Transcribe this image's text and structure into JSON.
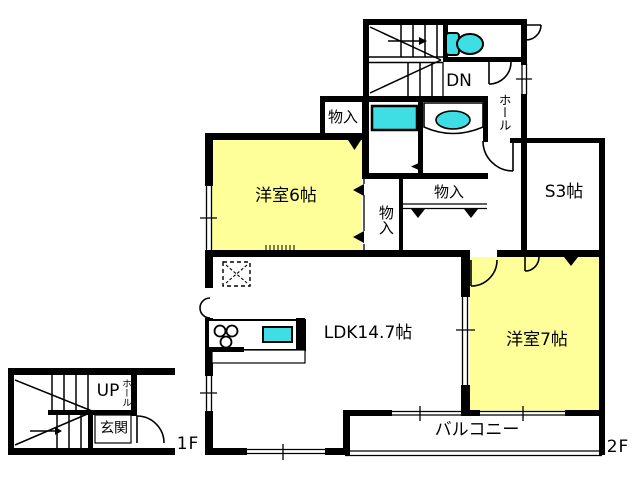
{
  "plan": {
    "floor_labels": {
      "first": "1F",
      "second": "2F"
    },
    "rooms": {
      "bedroom6": "洋室6帖",
      "bedroom7": "洋室7帖",
      "ldk": "LDK14.7帖",
      "storage_s3": "S3帖",
      "balcony": "バルコニー",
      "hall_2f": "ホール",
      "hall_1f": "ホール",
      "entrance": "玄関",
      "closet_top": "物入",
      "closet_middle": "物入",
      "closet_side": "物入"
    },
    "stairs": {
      "down": "DN",
      "up": "UP"
    },
    "colors": {
      "room_fill": "#FFFF99",
      "fixture_fill": "#3EDEE4",
      "wall": "#000000",
      "background": "#FFFFFF"
    },
    "fixtures": [
      "toilet-icon",
      "vanity-basin-icon",
      "washing-machine-pan-icon",
      "kitchen-sink-icon",
      "stove-burners-icon",
      "refrigerator-space-icon"
    ]
  }
}
